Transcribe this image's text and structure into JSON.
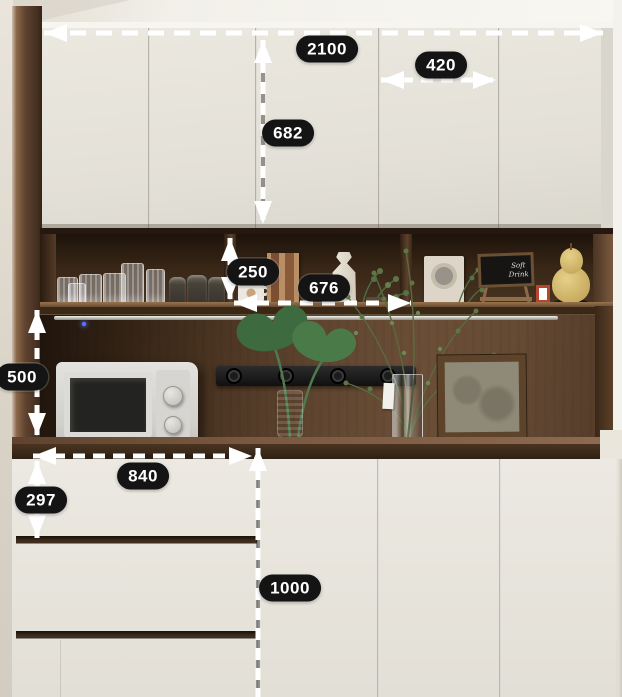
{
  "title": "Built-in kitchen sideboard with dimension annotations",
  "unit": "mm",
  "annotations": {
    "total_width": "2100",
    "door_width": "420",
    "upper_cabinet_height": "682",
    "shelf_compartment_height": "250",
    "middle_section_width": "676",
    "open_section_height": "500",
    "counter_run_width": "840",
    "top_drawer_height": "297",
    "base_cabinet_height": "1000"
  },
  "scene": {
    "chalkboard_text": "Soft Drink",
    "objects": [
      "crystal-glasses",
      "storage-canisters",
      "coffee-mug",
      "art-card",
      "white-vase",
      "potted-greenery",
      "photo-frame",
      "chalkboard-easel",
      "mini-red-frame",
      "gourd-ornament",
      "hanging-rail",
      "power-track",
      "microwave",
      "monstera-plant",
      "green-glass-vase",
      "branch-arrangement",
      "glass-cylinder-vase",
      "wooden-picture-frame",
      "indicator-led"
    ]
  },
  "palette": {
    "cabinet_door": "#e8e5dd",
    "wood_dark": "#3a2817",
    "wood_medium": "#6b4e37",
    "counter": "#402d1d",
    "label_bg": "#141414",
    "label_text": "#ffffff",
    "arrow": "#ffffff"
  }
}
